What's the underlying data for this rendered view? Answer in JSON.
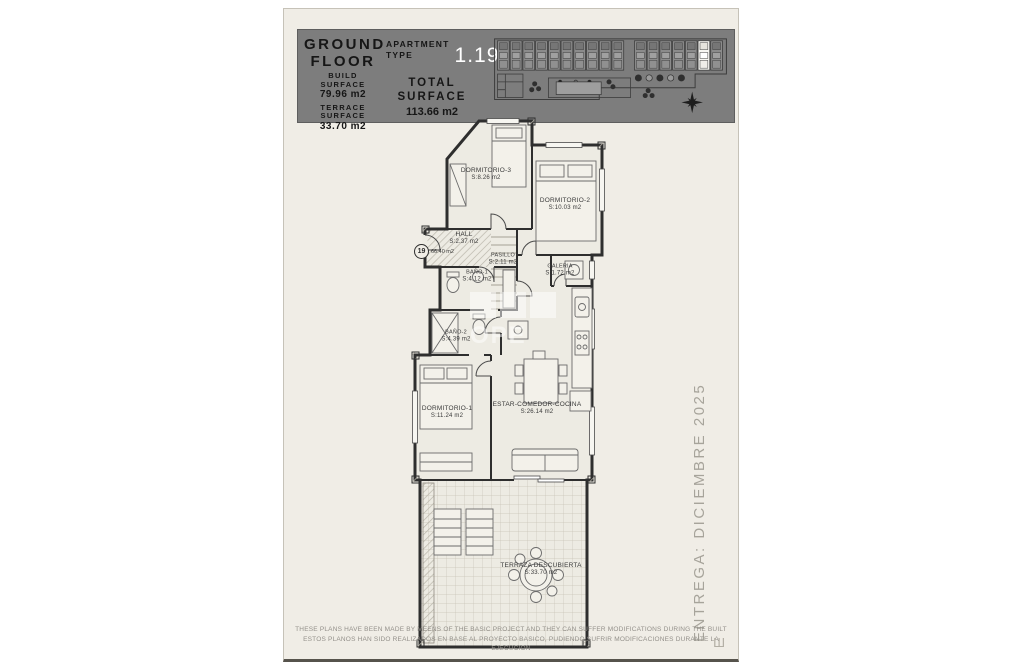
{
  "header": {
    "title_line1": "GROUND",
    "title_line2": "FLOOR",
    "build_label1": "BUILD",
    "build_label2": "SURFACE",
    "build_value": "79.96 m2",
    "terrace_label1": "TERRACE",
    "terrace_label2": "SURFACE",
    "terrace_value": "33.70 m2",
    "apartment_label1": "APARTMENT",
    "apartment_label2": "TYPE",
    "apartment_value": "1.19",
    "total_label1": "TOTAL",
    "total_label2": "SURFACE",
    "total_value": "113.66 m2",
    "bg_color": "#7d7d7d",
    "highlight_unit_color": "#ffffff"
  },
  "plan": {
    "unit_marker": "19",
    "useful_surface": "66.40 m2",
    "rooms": [
      {
        "name": "DORMITORIO-3",
        "area": "S:8.26 m2"
      },
      {
        "name": "DORMITORIO-2",
        "area": "S:10.03 m2"
      },
      {
        "name": "HALL",
        "area": "S:2.37 m2"
      },
      {
        "name": "PASILLO",
        "area": "S:2.11 m2"
      },
      {
        "name": "BAÑO-1",
        "area": "S:4.12 m2"
      },
      {
        "name": "GALERIA",
        "area": "S:1.72 m2"
      },
      {
        "name": "BAÑO-2",
        "area": "S:4.39 m2"
      },
      {
        "name": "DORMITORIO-1",
        "area": "S:11.24 m2"
      },
      {
        "name": "ESTAR-COMEDOR-COCINA",
        "area": "S:26.14 m2"
      },
      {
        "name": "TERRAZA DESCUBIERTA",
        "area": "S:33.70 m2"
      }
    ]
  },
  "watermark": {
    "text": "OPE"
  },
  "side_note": "ENTREGA: DICIEMBRE 2025",
  "footer": {
    "line_en": "THESE PLANS HAVE BEEN MADE BY MEENS OF THE BASIC PROJECT AND THEY CAN SUFFER MODIFICATIONS DURING THE BUILT",
    "line_es": "ESTOS PLANOS HAN SIDO REALIZADOS EN BASE AL PROYECTO BASICO, PUDIENDO SUFRIR MODIFICACIONES DURANTE LA EJECUCION"
  }
}
